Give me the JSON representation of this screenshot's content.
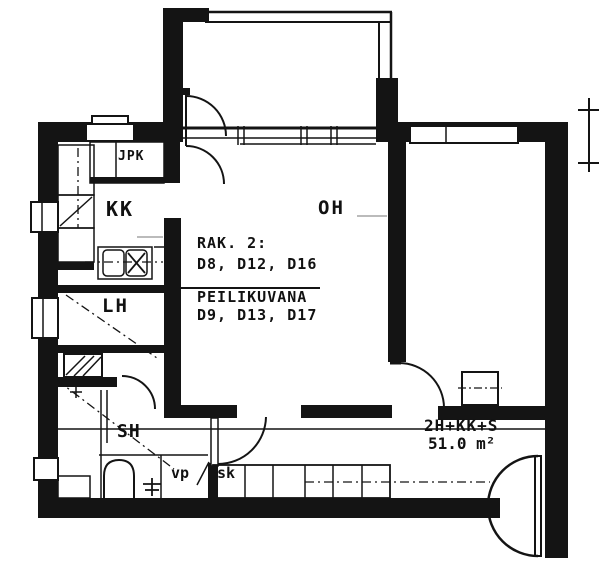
{
  "plan": {
    "rooms": {
      "jpk": "JPK",
      "kk": "KK",
      "oh": "OH",
      "lh": "LH",
      "sh": "SH",
      "vp": "vp",
      "sk": "sk"
    },
    "annotation": {
      "line1": "RAK. 2:",
      "line2": "D8, D12, D16",
      "line3": "PEILIKUVANA",
      "line4": "D9, D13, D17"
    },
    "summary": {
      "apartment_type": "2H+KK+S",
      "area": "51.0 m²"
    },
    "colors": {
      "ink": "#141414",
      "paper": "#ffffff"
    }
  }
}
